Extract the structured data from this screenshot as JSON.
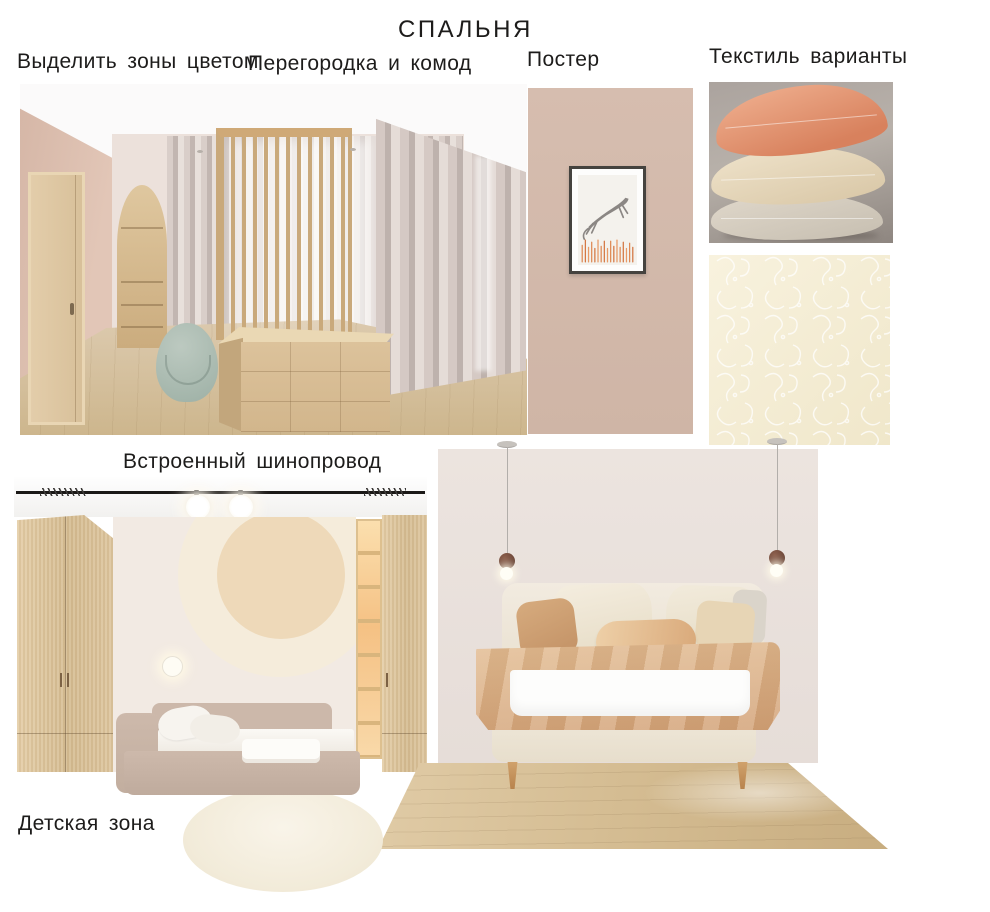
{
  "title": "СПАЛЬНЯ",
  "labels": {
    "highlight_zones": "Выделить зоны цветом",
    "partition_dresser": "Перегородка и комод",
    "poster": "Постер",
    "textile_options": "Текстиль варианты",
    "track_lighting": "Встроенный шинопровод",
    "kids_zone": "Детская зона"
  },
  "palette": {
    "text": "#1d1c1b",
    "poster_wall_taupe": "#d2b9ab",
    "blush_wall": "#ddc0b1",
    "greige_wall": "#e9e1dc",
    "light_wood": "#dcc49e",
    "floor_wood": "#d3bc92",
    "curtain_greige": "#cfc3bf",
    "sage_pouf": "#a9bbb1",
    "pillow_salmon": "#e69b7d",
    "pillow_cream": "#e7d9c0",
    "pillow_grey": "#d3ccc0",
    "fabric_cream": "#f5eed9",
    "blanket_caramel": "#d9ae83",
    "bed_upholstery": "#efe8da",
    "kids_bed_taupe": "#c9b5a8",
    "pendant_brown": "#6e473a",
    "shelf_glow": "#f5c184",
    "track_black": "#1b1917"
  }
}
